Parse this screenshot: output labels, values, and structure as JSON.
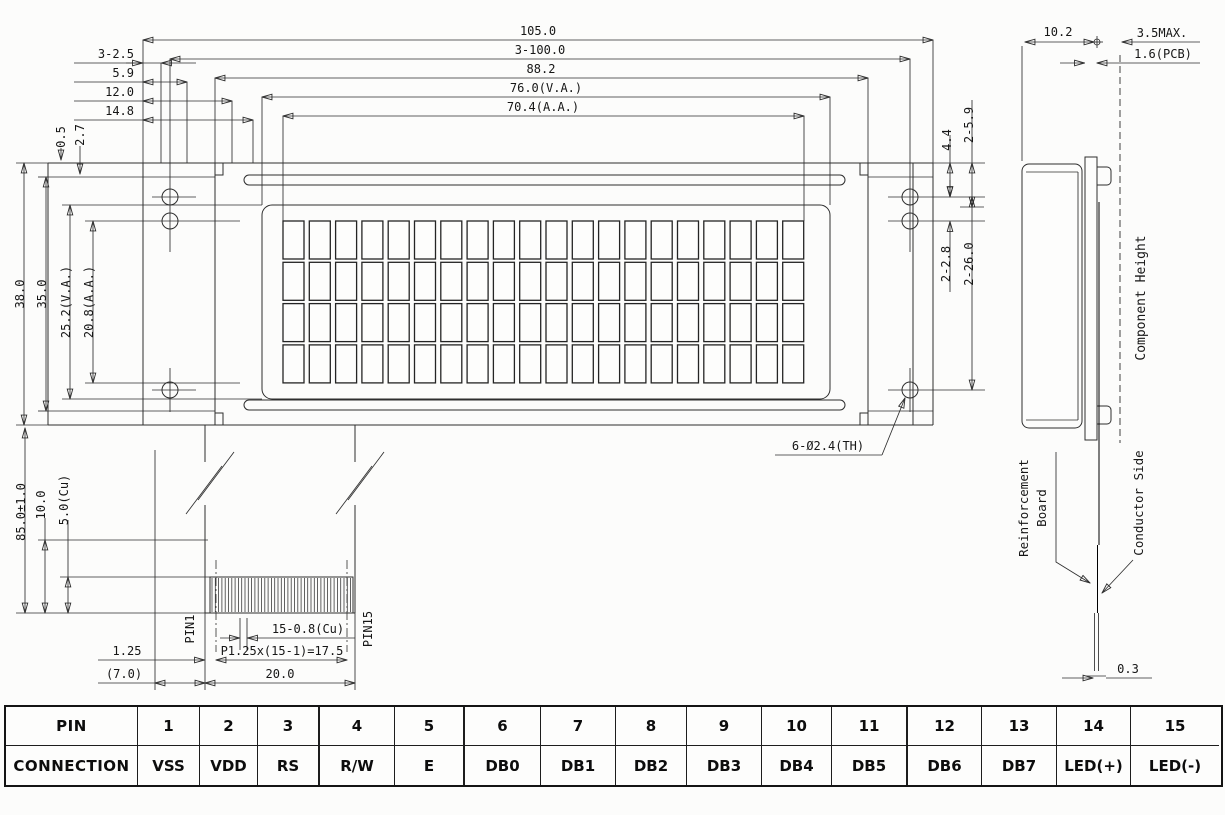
{
  "colors": {
    "line": "#2e2e2e",
    "text": "#161616",
    "background": "#fcfcfb"
  },
  "drawing": {
    "front_view": {
      "top_dims": [
        "105.0",
        "3-100.0",
        "88.2",
        "76.0(V.A.)",
        "70.4(A.A.)"
      ],
      "left_edge_dims": [
        "3-2.5",
        "5.9",
        "12.0",
        "14.8"
      ],
      "left_micro_dims": [
        "0.5",
        "2.7"
      ],
      "left_vertical_dims": [
        "38.0",
        "35.0",
        "25.2(V.A.)",
        "20.8(A.A.)"
      ],
      "right_vertical_dims": [
        "4.4",
        "2-5.9",
        "2-2.8",
        "2-26.0"
      ],
      "hole_callout": "6-Ø2.4(TH)",
      "display": {
        "rows": 4,
        "columns": 20
      }
    },
    "tail_view": {
      "overall_length": "85.0±1.0",
      "exposed_length": "10.0",
      "plating_length": "5.0(Cu)",
      "pin_first": "PIN1",
      "pin_last": "PIN15",
      "conductor_width": "15-0.8(Cu)",
      "pitch_formula": "P1.25x(15-1)=17.5",
      "edge_offset": "1.25",
      "ref_width": "(7.0)",
      "tail_width": "20.0"
    },
    "side_view": {
      "depth": "10.2",
      "component_height_max": "3.5MAX.",
      "pcb_thickness": "1.6(PCB)",
      "component_height_label": "Component Height",
      "reinforcement_line1": "Reinforcement",
      "reinforcement_line2": "Board",
      "conductor_label": "Conductor Side",
      "tail_thickness": "0.3"
    }
  },
  "pin_table": {
    "row1_header": "PIN",
    "row2_header": "CONNECTION",
    "pins": [
      "1",
      "2",
      "3",
      "4",
      "5",
      "6",
      "7",
      "8",
      "9",
      "10",
      "11",
      "12",
      "13",
      "14",
      "15"
    ],
    "connections": [
      "VSS",
      "VDD",
      "RS",
      "R/W",
      "E",
      "DB0",
      "DB1",
      "DB2",
      "DB3",
      "DB4",
      "DB5",
      "DB6",
      "DB7",
      "LED(+)",
      "LED(-)"
    ]
  }
}
